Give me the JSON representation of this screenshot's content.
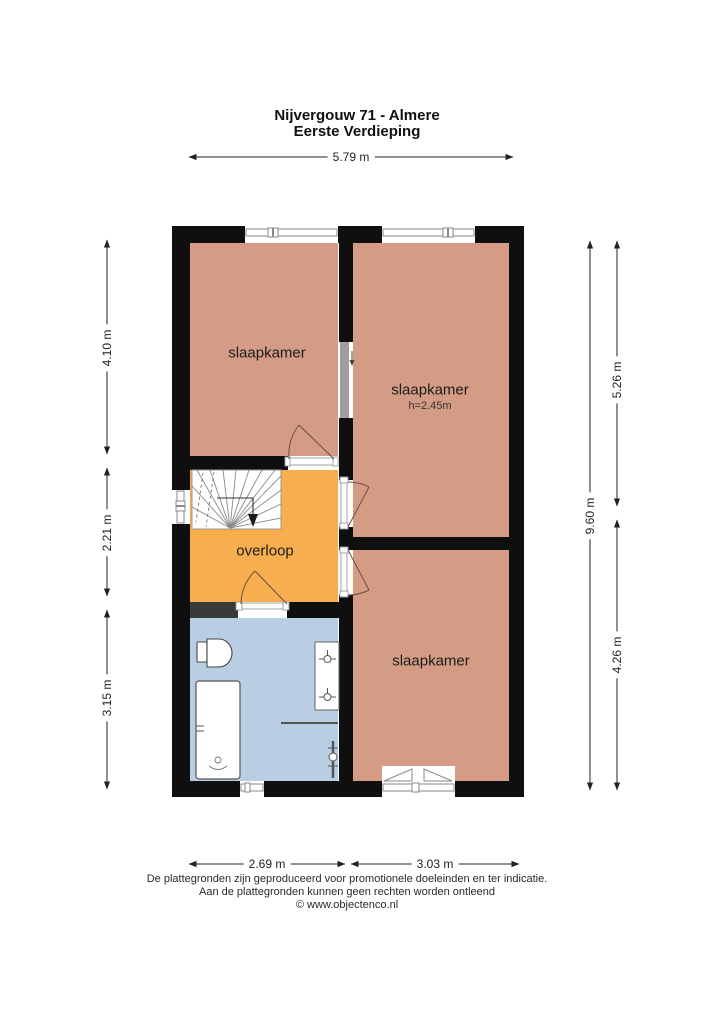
{
  "title": {
    "line1": "Nijvergouw 71 - Almere",
    "line2": "Eerste Verdieping"
  },
  "rooms": [
    {
      "name": "bedroom-top-left",
      "label": "slaapkamer"
    },
    {
      "name": "bedroom-top-right",
      "label": "slaapkamer",
      "height_note": "h=2.45m"
    },
    {
      "name": "landing",
      "label": "overloop"
    },
    {
      "name": "bedroom-bottom-right",
      "label": "slaapkamer"
    },
    {
      "name": "bathroom",
      "label": ""
    }
  ],
  "dimensions": {
    "top": "5.79 m",
    "left": [
      "4.10 m",
      "2.21 m",
      "3.15 m"
    ],
    "right_inner": "9.60 m",
    "right_outer": [
      "5.26 m",
      "4.26 m"
    ],
    "bottom": [
      "2.69 m",
      "3.03 m"
    ]
  },
  "footer": {
    "line1": "De plattegronden zijn geproduceerd voor promotionele doeleinden en ter indicatie.",
    "line2": "Aan de plattegronden kunnen geen rechten worden ontleend",
    "line3": "© www.objectenco.nl"
  },
  "colors": {
    "bedroom": "#d49c84",
    "landing": "#f6ae4f",
    "bathroom": "#b9cee3",
    "wall": "#0f0f0f",
    "partition": "#9e9e9e",
    "shaft": "#3a3a3a",
    "window_line": "#8a8a8a",
    "dimension": "#222222"
  }
}
